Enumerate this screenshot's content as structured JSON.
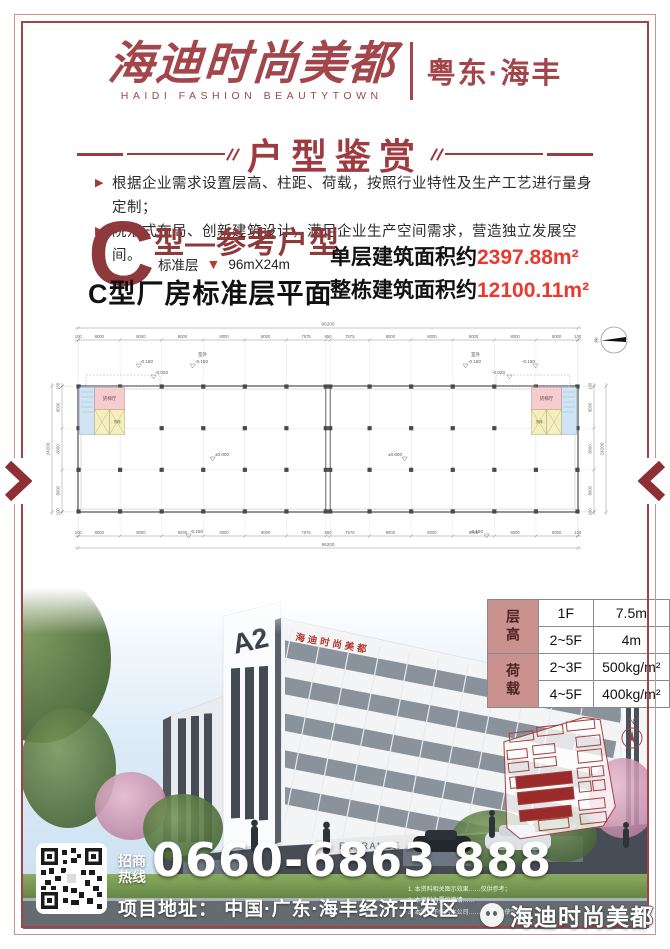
{
  "brand": {
    "logo_cn": "海迪时尚美都",
    "logo_en": "HAIDI  FASHION  BEAUTYTOWN",
    "region": "粤东·海丰",
    "watermark": "海迪时尚美都"
  },
  "banner": {
    "title": "户型鉴赏"
  },
  "features": [
    {
      "text": "根据企业需求设置层高、柱距、荷载，按照行业特性及生产工艺进行量身定制；"
    },
    {
      "text": "院落式布局、创新建筑设计，满足企业生产空间需求，营造独立发展空间。"
    }
  ],
  "unit": {
    "big_letter": "C",
    "type_title": "型—参考户型",
    "floor_label": "标准层",
    "size": "96mX24m",
    "plan_title": "C型厂房标准层平面",
    "area_lines": [
      {
        "prefix": "单层建筑面积约",
        "value": "2397.88m²"
      },
      {
        "prefix": "整栋建筑面积约",
        "value": "12100.11m²"
      }
    ]
  },
  "floor_plan": {
    "total_width_label": "96200",
    "total_height_label": "24200",
    "segment_labels": [
      "100",
      "8000",
      "8000",
      "8000",
      "8000",
      "8000",
      "7575",
      "850",
      "7575",
      "8000",
      "8000",
      "8000",
      "8000",
      "8000",
      "100"
    ],
    "segment_values": [
      100,
      8000,
      8000,
      8000,
      8000,
      8000,
      7575,
      850,
      7575,
      8000,
      8000,
      8000,
      8000,
      8000,
      100
    ],
    "side_labels": [
      "100",
      "8000",
      "8000",
      "8000",
      "100"
    ],
    "side_values": [
      100,
      8000,
      8000,
      8000,
      100
    ],
    "labels": {
      "outdoor": "室外",
      "lvl_outdoor": "-0.150",
      "lvl_door": "-0.020",
      "lvl_inside": "±0.000",
      "lvl_bottom": "-0.150",
      "north": "北"
    },
    "rooms": {
      "lobby": "货梯厅",
      "lift": "货梯",
      "stair": "楼梯"
    }
  },
  "spec_table": {
    "groups": [
      {
        "label": "层高",
        "rows": [
          [
            "1F",
            "7.5m"
          ],
          [
            "2~5F",
            "4m"
          ]
        ]
      },
      {
        "label": "荷载",
        "rows": [
          [
            "2~3F",
            "500kg/m²"
          ],
          [
            "4~5F",
            "400kg/m²"
          ]
        ]
      }
    ]
  },
  "photo": {
    "tower_sign": "A2",
    "roof_sign": "海迪时尚美都",
    "entrance_sign": "ENTRANCE",
    "minimap_north": "N"
  },
  "contact": {
    "hotline_label_1": "招商",
    "hotline_label_2": "热线",
    "phone": "0660-6863 888",
    "address": "项目地址： 中国·广东·海丰经济开发区"
  },
  "disclaimers": [
    "1. 本资料相关图示效果……仅供参考；",
    "2. 本资料为要约邀请……",
    "3. 本资料不作为本公司……合同附件使用……"
  ],
  "colors": {
    "brand_red": "#a3464b",
    "deep_red": "#8e393c",
    "accent_red": "#e83a2e",
    "table_label_bg": "#c9928f",
    "minimap_fill": "#9b2b2b"
  }
}
